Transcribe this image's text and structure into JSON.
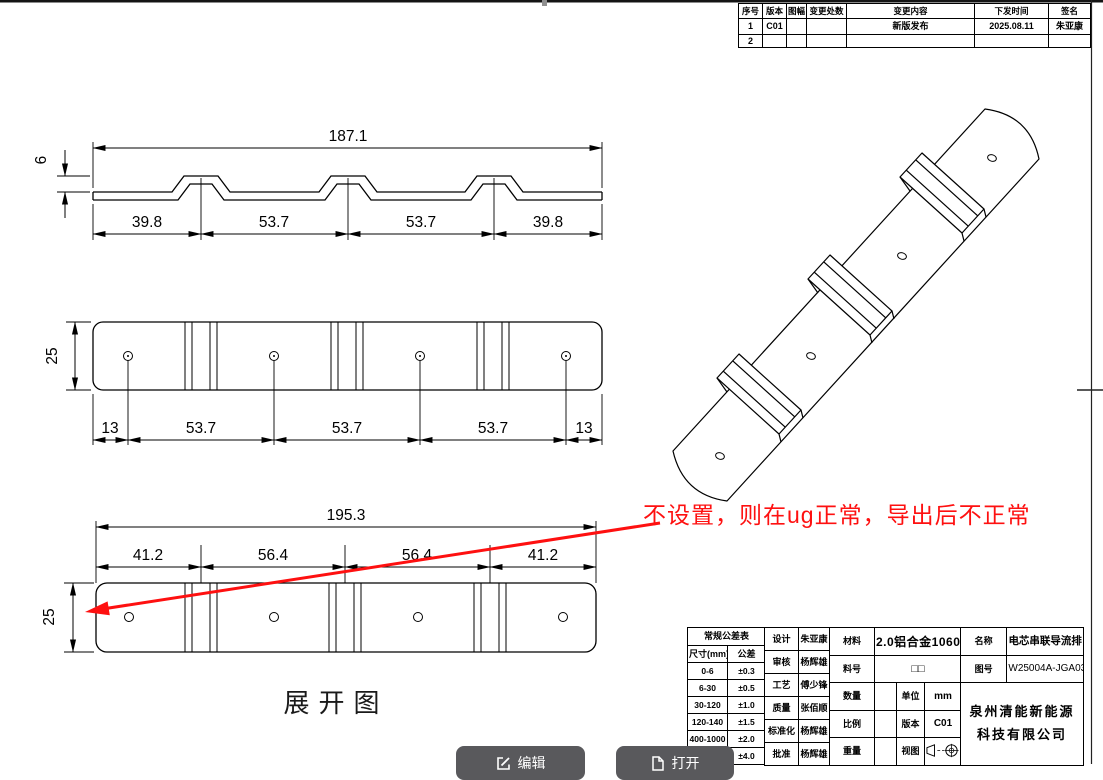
{
  "annotation": {
    "text": "不设置，则在ug正常，导出后不正常",
    "color": "#fe1010"
  },
  "views": {
    "profile": {
      "overall": "187.1",
      "height": "6",
      "segments": [
        "39.8",
        "53.7",
        "53.7",
        "39.8"
      ]
    },
    "plan": {
      "height": "25",
      "segments": [
        "13",
        "53.7",
        "53.7",
        "53.7",
        "13"
      ]
    },
    "unfold": {
      "overall": "195.3",
      "height": "25",
      "segments": [
        "41.2",
        "56.4",
        "56.4",
        "41.2"
      ],
      "caption": "展开图"
    }
  },
  "revision_table": {
    "headers": [
      "序号",
      "版本",
      "图幅",
      "变更处数",
      "变更内容",
      "下发时间",
      "签名"
    ],
    "rows": [
      [
        "1",
        "C01",
        "",
        "",
        "新版发布",
        "2025.08.11",
        "朱亚康"
      ],
      [
        "2",
        "",
        "",
        "",
        "",
        "",
        ""
      ]
    ]
  },
  "tolerance_table": {
    "title": "常规公差表",
    "headers": [
      "尺寸(mm)",
      "公差"
    ],
    "rows": [
      [
        "0-6",
        "±0.3"
      ],
      [
        "6-30",
        "±0.5"
      ],
      [
        "30-120",
        "±1.0"
      ],
      [
        "120-140",
        "±1.5"
      ],
      [
        "400-1000",
        "±2.0"
      ],
      [
        "≥1000",
        "±4.0"
      ]
    ]
  },
  "title_block": {
    "roles": [
      {
        "label": "设计",
        "name": "朱亚康"
      },
      {
        "label": "审核",
        "name": "杨辉雄"
      },
      {
        "label": "工艺",
        "name": "傅少锋"
      },
      {
        "label": "质量",
        "name": "张佰顺"
      },
      {
        "label": "标准化",
        "name": "杨辉雄"
      },
      {
        "label": "批准",
        "name": "杨辉雄"
      }
    ],
    "fields": {
      "material_label": "材料",
      "material_value": "2.0铝合金1060",
      "part_label": "料号",
      "part_value": "□□",
      "qty_label": "数量",
      "qty_value": "",
      "unit_label": "单位",
      "unit_value": "mm",
      "scale_label": "比例",
      "scale_value": "",
      "ver_label": "版本",
      "ver_value": "C01",
      "weight_label": "重量",
      "weight_value": "",
      "view_label": "视图",
      "name_label": "名称",
      "name_value": "电芯串联导流排",
      "dwg_label": "图号",
      "dwg_value": "W25004A-JGA03",
      "company_line1": "泉州清能新能源",
      "company_line2": "科技有限公司"
    }
  },
  "buttons": {
    "edit": "编辑",
    "open": "打开"
  }
}
